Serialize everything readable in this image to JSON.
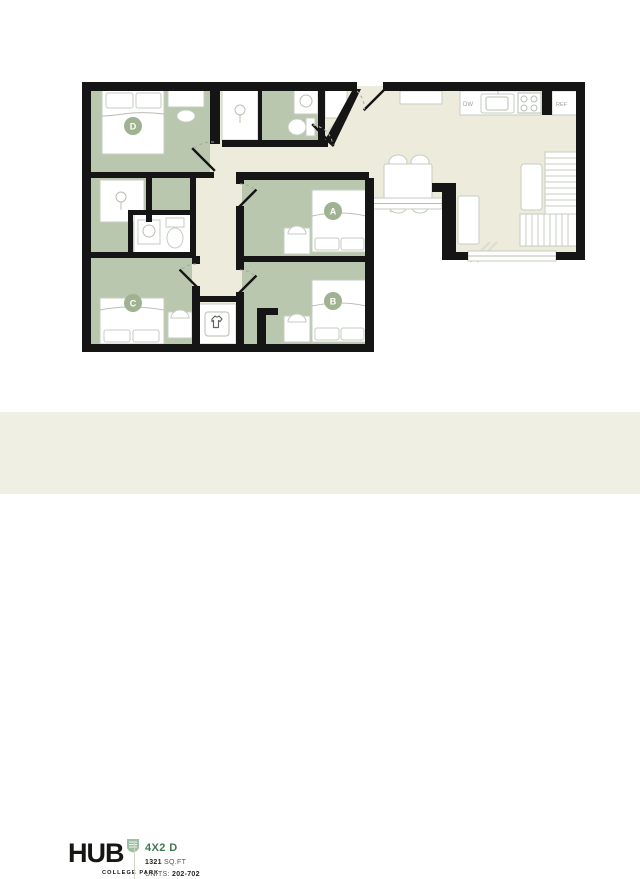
{
  "plan": {
    "rooms": [
      {
        "id": "A",
        "label": "A"
      },
      {
        "id": "B",
        "label": "B"
      },
      {
        "id": "C",
        "label": "C"
      },
      {
        "id": "D",
        "label": "D"
      }
    ],
    "kitchen": {
      "dishwasher_label": "DW",
      "refrigerator_label": "REF"
    },
    "icons": {
      "laundry": "laundry-shirt-icon",
      "closet": "hanger-rod-icon",
      "bath": [
        "sink-icon",
        "toilet-icon"
      ],
      "cooking": "stove-burners-icon"
    },
    "colors": {
      "wall": "#151515",
      "bedroom_fill": "#b9c7ae",
      "floor_fill": "#edecdc",
      "label_badge": "#9fb392"
    }
  },
  "footer": {
    "brand": "HUB",
    "brand_sub": "COLLEGE PARK",
    "unit_title": "4X2 D",
    "sqft_value": "1321",
    "sqft_unit": "SQ.FT",
    "units_label": "UNITS:",
    "units_value": "202-702",
    "accent_color": "#3d7a50",
    "background": "#f0efe3"
  }
}
